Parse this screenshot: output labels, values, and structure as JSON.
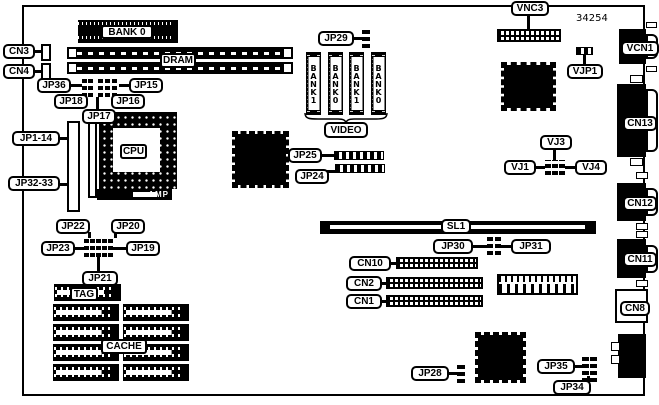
{
  "diagram": {
    "part_number": "34254",
    "memory": {
      "bank0": "BANK 0",
      "dram": "DRAM",
      "video": "VIDEO",
      "video_banks": [
        "BANK1",
        "BANK0",
        "BANK1",
        "BANK0"
      ]
    },
    "cpu": {
      "label": "CPU",
      "amp": "AMP"
    },
    "cache": {
      "tag": "TAG",
      "label": "CACHE"
    },
    "slots": {
      "sl1": "SL1"
    },
    "jumpers": {
      "jp1_14": "JP1-14",
      "jp32_33": "JP32-33",
      "jp36": "JP36",
      "jp15": "JP15",
      "jp18": "JP18",
      "jp16": "JP16",
      "jp17": "JP17",
      "jp22": "JP22",
      "jp20": "JP20",
      "jp23": "JP23",
      "jp19": "JP19",
      "jp21": "JP21",
      "jp24": "JP24",
      "jp25": "JP25",
      "jp28": "JP28",
      "jp29": "JP29",
      "jp30": "JP30",
      "jp31": "JP31",
      "jp34": "JP34",
      "jp35": "JP35",
      "vjp1": "VJP1",
      "vj1": "VJ1",
      "vj3": "VJ3",
      "vj4": "VJ4"
    },
    "connectors": {
      "cn1": "CN1",
      "cn2": "CN2",
      "cn3": "CN3",
      "cn4": "CN4",
      "cn8": "CN8",
      "cn10": "CN10",
      "cn11": "CN11",
      "cn12": "CN12",
      "cn13": "CN13",
      "vnc3": "VNC3",
      "vcn1": "VCN1"
    }
  }
}
